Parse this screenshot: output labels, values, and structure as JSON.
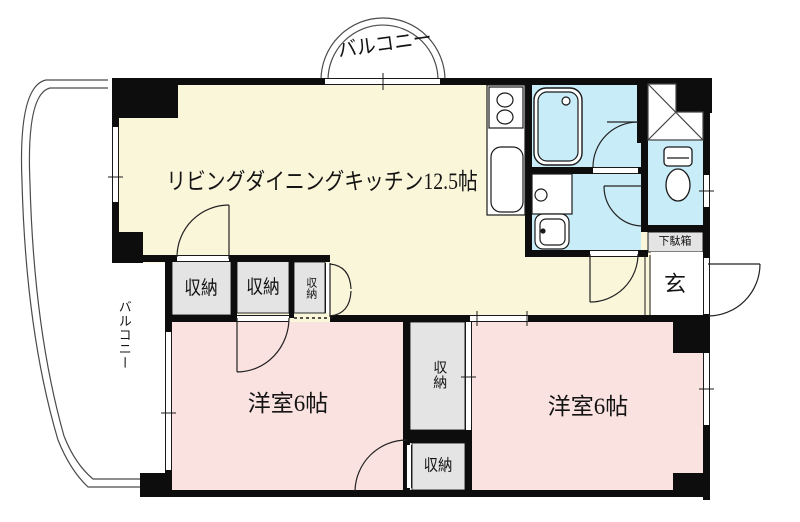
{
  "floorplan": {
    "labels": {
      "ldk": "リビングダイニングキッチン12.5帖",
      "bedroom_left": "洋室6帖",
      "bedroom_right": "洋室6帖",
      "balcony_top": "バルコニー",
      "balcony_left": "バルコニー",
      "closet_living": "収納",
      "closet_bedroom_left": "収納",
      "closet_hall": "収納",
      "closet_middle": "収納",
      "closet_lower": "収納",
      "shoe_cabinet": "下駄箱",
      "entrance": "玄"
    },
    "colors": {
      "ldk": "#faf6da",
      "bedroom": "#fae2e1",
      "wet_area": "#c9edf8",
      "closet": "#e4e4e4",
      "fixture": "#ffffff",
      "wall": "#0d0d0d"
    }
  }
}
